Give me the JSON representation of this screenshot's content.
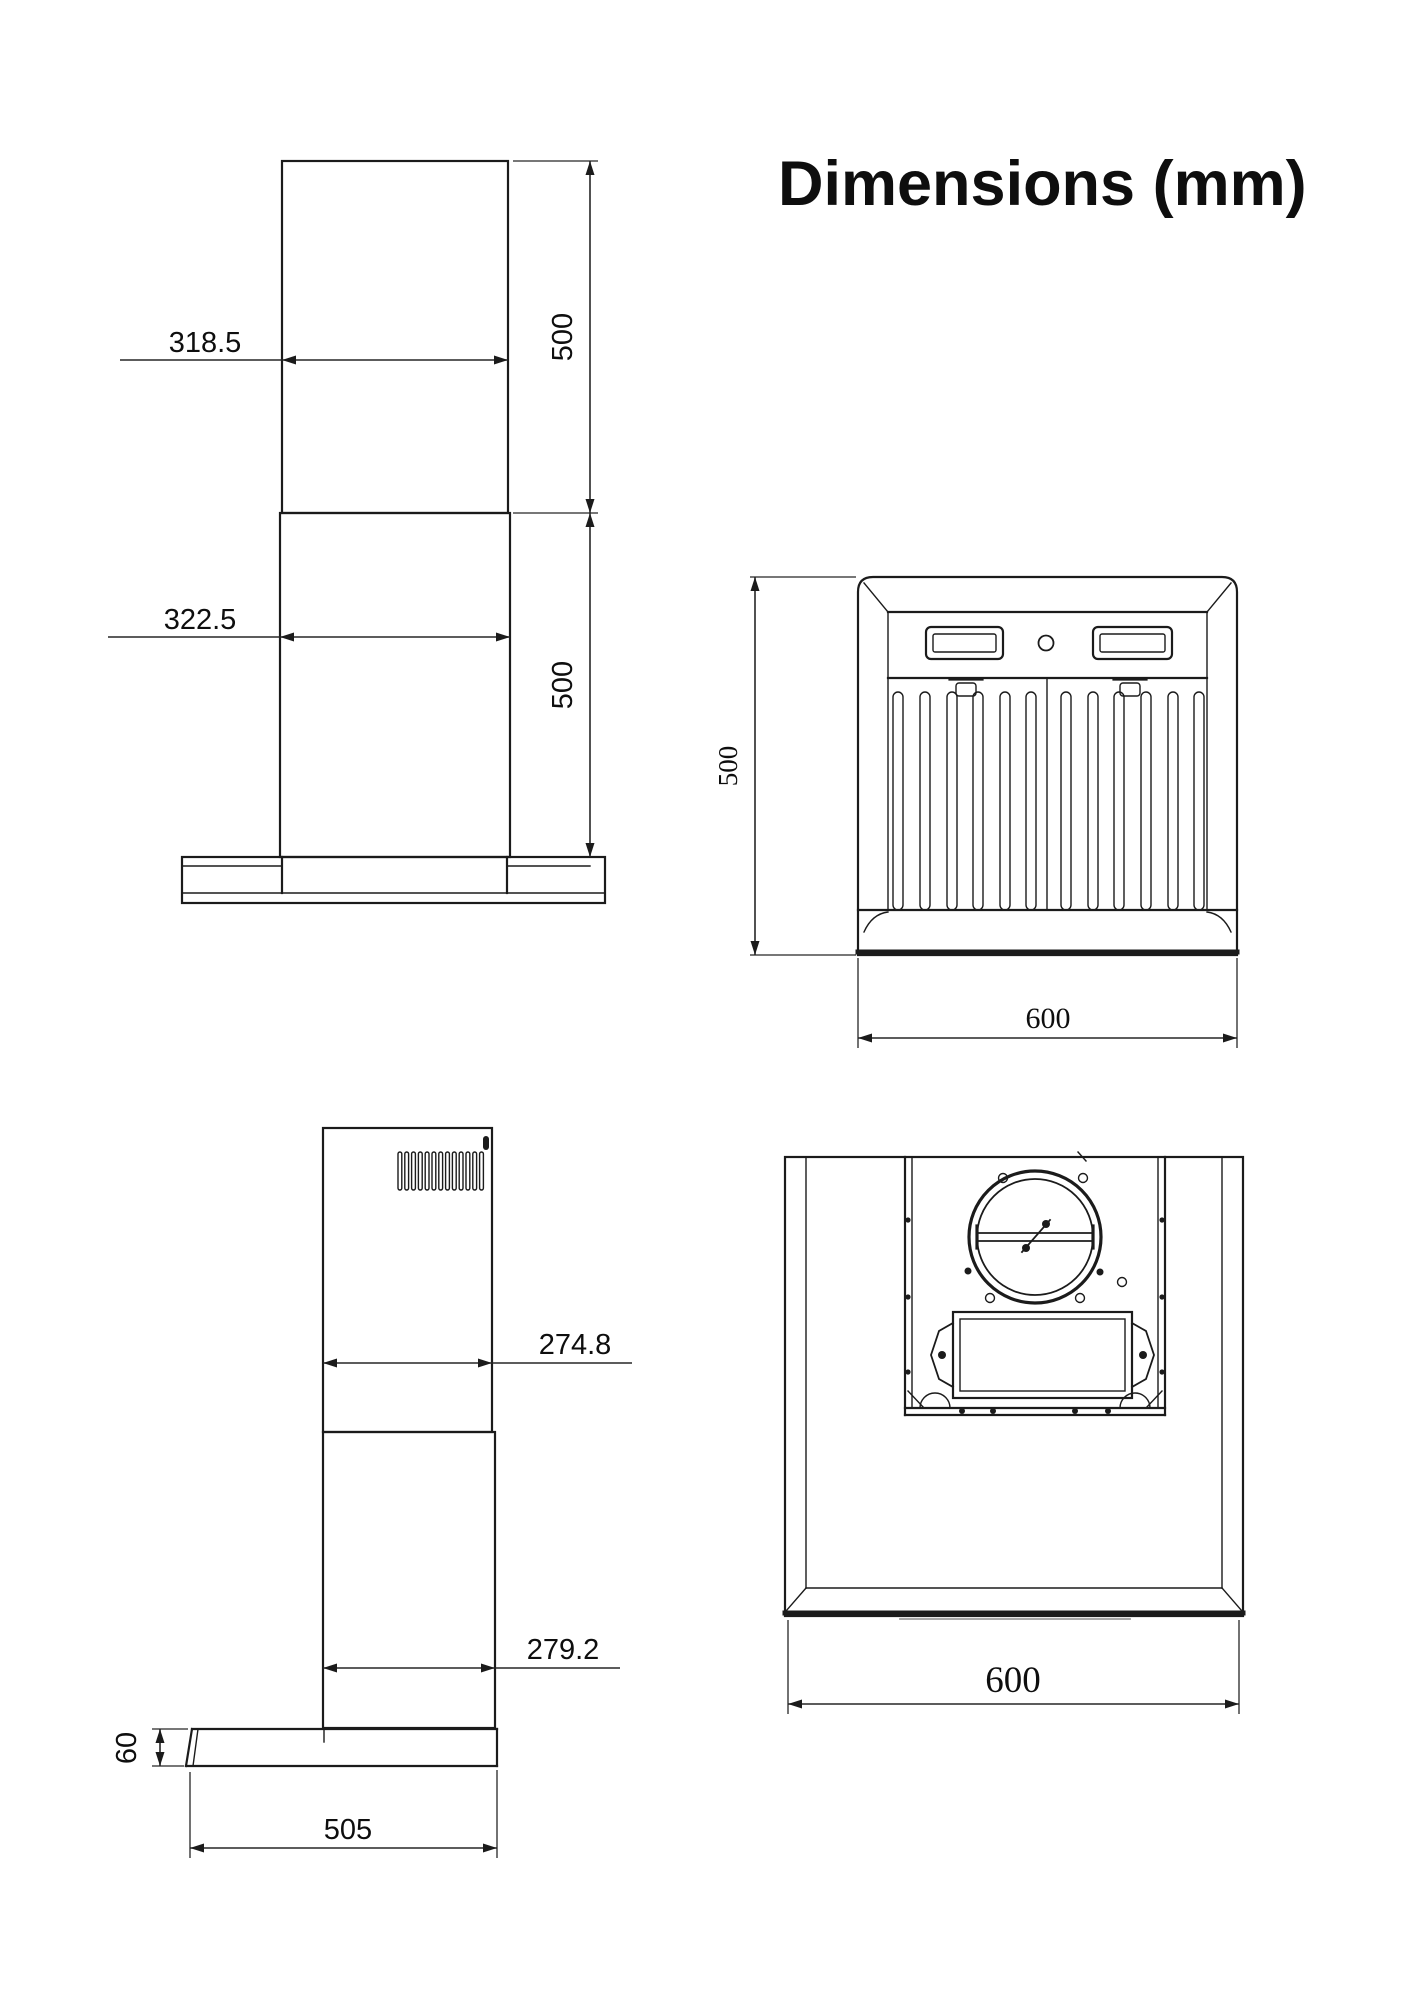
{
  "title": "Dimensions (mm)",
  "units": "mm",
  "views": {
    "chimney_front": {
      "upper_width": "318.5",
      "lower_width": "322.5",
      "upper_height": "500",
      "lower_height": "500"
    },
    "hood_front": {
      "height": "500",
      "width": "600"
    },
    "hood_side": {
      "upper_depth": "274.8",
      "lower_depth": "279.2",
      "base_height": "60",
      "base_depth": "505"
    },
    "hood_top": {
      "width": "600"
    }
  }
}
